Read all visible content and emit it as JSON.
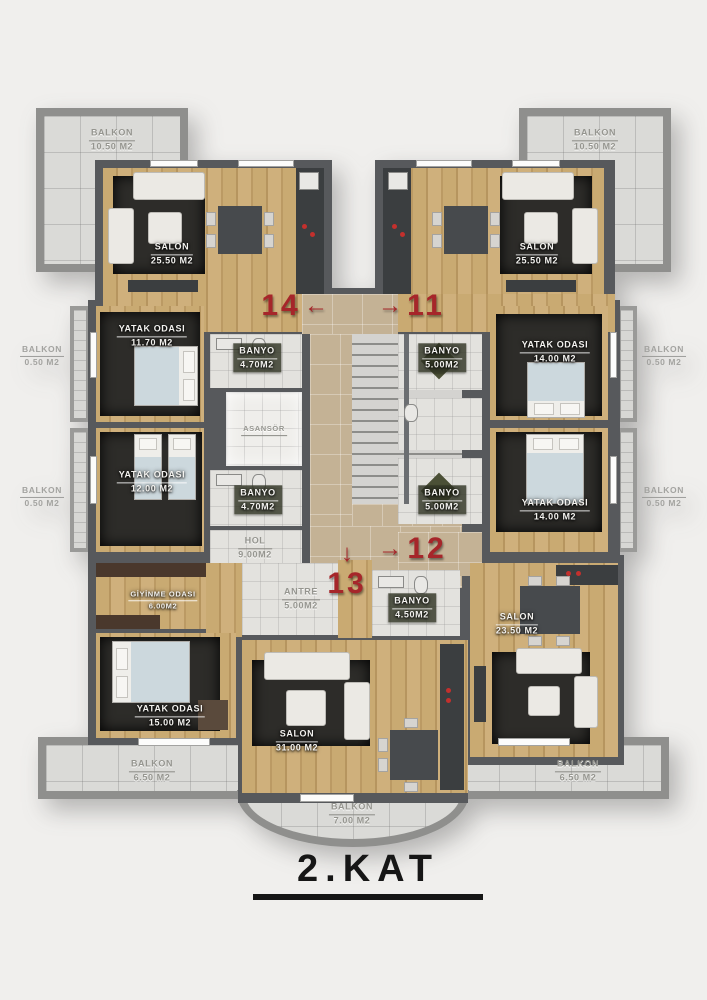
{
  "title": "2.KAT",
  "colors": {
    "wall": "#57595c",
    "wood_floor": "#c9aa72",
    "hall_tile": "#c4b295",
    "white_tile": "#e3e2de",
    "balcony_tile": "#dadad7",
    "rug": "#2d2c29",
    "unit_number_red": "#a6262a",
    "label_text": "#f3f2ef"
  },
  "unit_numbers": [
    {
      "number": "14",
      "arrow": "←"
    },
    {
      "number": "11",
      "arrow": "→"
    },
    {
      "number": "13",
      "arrow": "↓"
    },
    {
      "number": "12",
      "arrow": "→"
    }
  ],
  "rooms": [
    {
      "name": "SALON",
      "area": "25.50 M2"
    },
    {
      "name": "SALON",
      "area": "25.50 M2"
    },
    {
      "name": "YATAK ODASI",
      "area": "11.70 M2"
    },
    {
      "name": "BANYO",
      "area": "4.70M2"
    },
    {
      "name": "ASANSÖR",
      "area": ""
    },
    {
      "name": "YATAK ODASI",
      "area": "12.00 M2"
    },
    {
      "name": "BANYO",
      "area": "4.70M2"
    },
    {
      "name": "HOL",
      "area": "9.00M2"
    },
    {
      "name": "BANYO",
      "area": "5.00M2"
    },
    {
      "name": "YATAK ODASI",
      "area": "14.00 M2"
    },
    {
      "name": "BANYO",
      "area": "5.00M2"
    },
    {
      "name": "YATAK ODASI",
      "area": "14.00 M2"
    },
    {
      "name": "GİYİNME ODASI",
      "area": "6.00M2"
    },
    {
      "name": "ANTRE",
      "area": "5.00M2"
    },
    {
      "name": "BANYO",
      "area": "4.50M2"
    },
    {
      "name": "SALON",
      "area": "23.50 M2"
    },
    {
      "name": "YATAK ODASI",
      "area": "15.00 M2"
    },
    {
      "name": "SALON",
      "area": "31.00 M2"
    }
  ],
  "balconies": [
    {
      "name": "BALKON",
      "area": "10.50 M2"
    },
    {
      "name": "BALKON",
      "area": "10.50 M2"
    },
    {
      "name": "BALKON",
      "area": "0.50 M2"
    },
    {
      "name": "BALKON",
      "area": "0.50 M2"
    },
    {
      "name": "BALKON",
      "area": "0.50 M2"
    },
    {
      "name": "BALKON",
      "area": "0.50 M2"
    },
    {
      "name": "BALKON",
      "area": "6.50 M2"
    },
    {
      "name": "BALKON",
      "area": "6.50 M2"
    },
    {
      "name": "BALKON",
      "area": "7.00 M2"
    }
  ]
}
